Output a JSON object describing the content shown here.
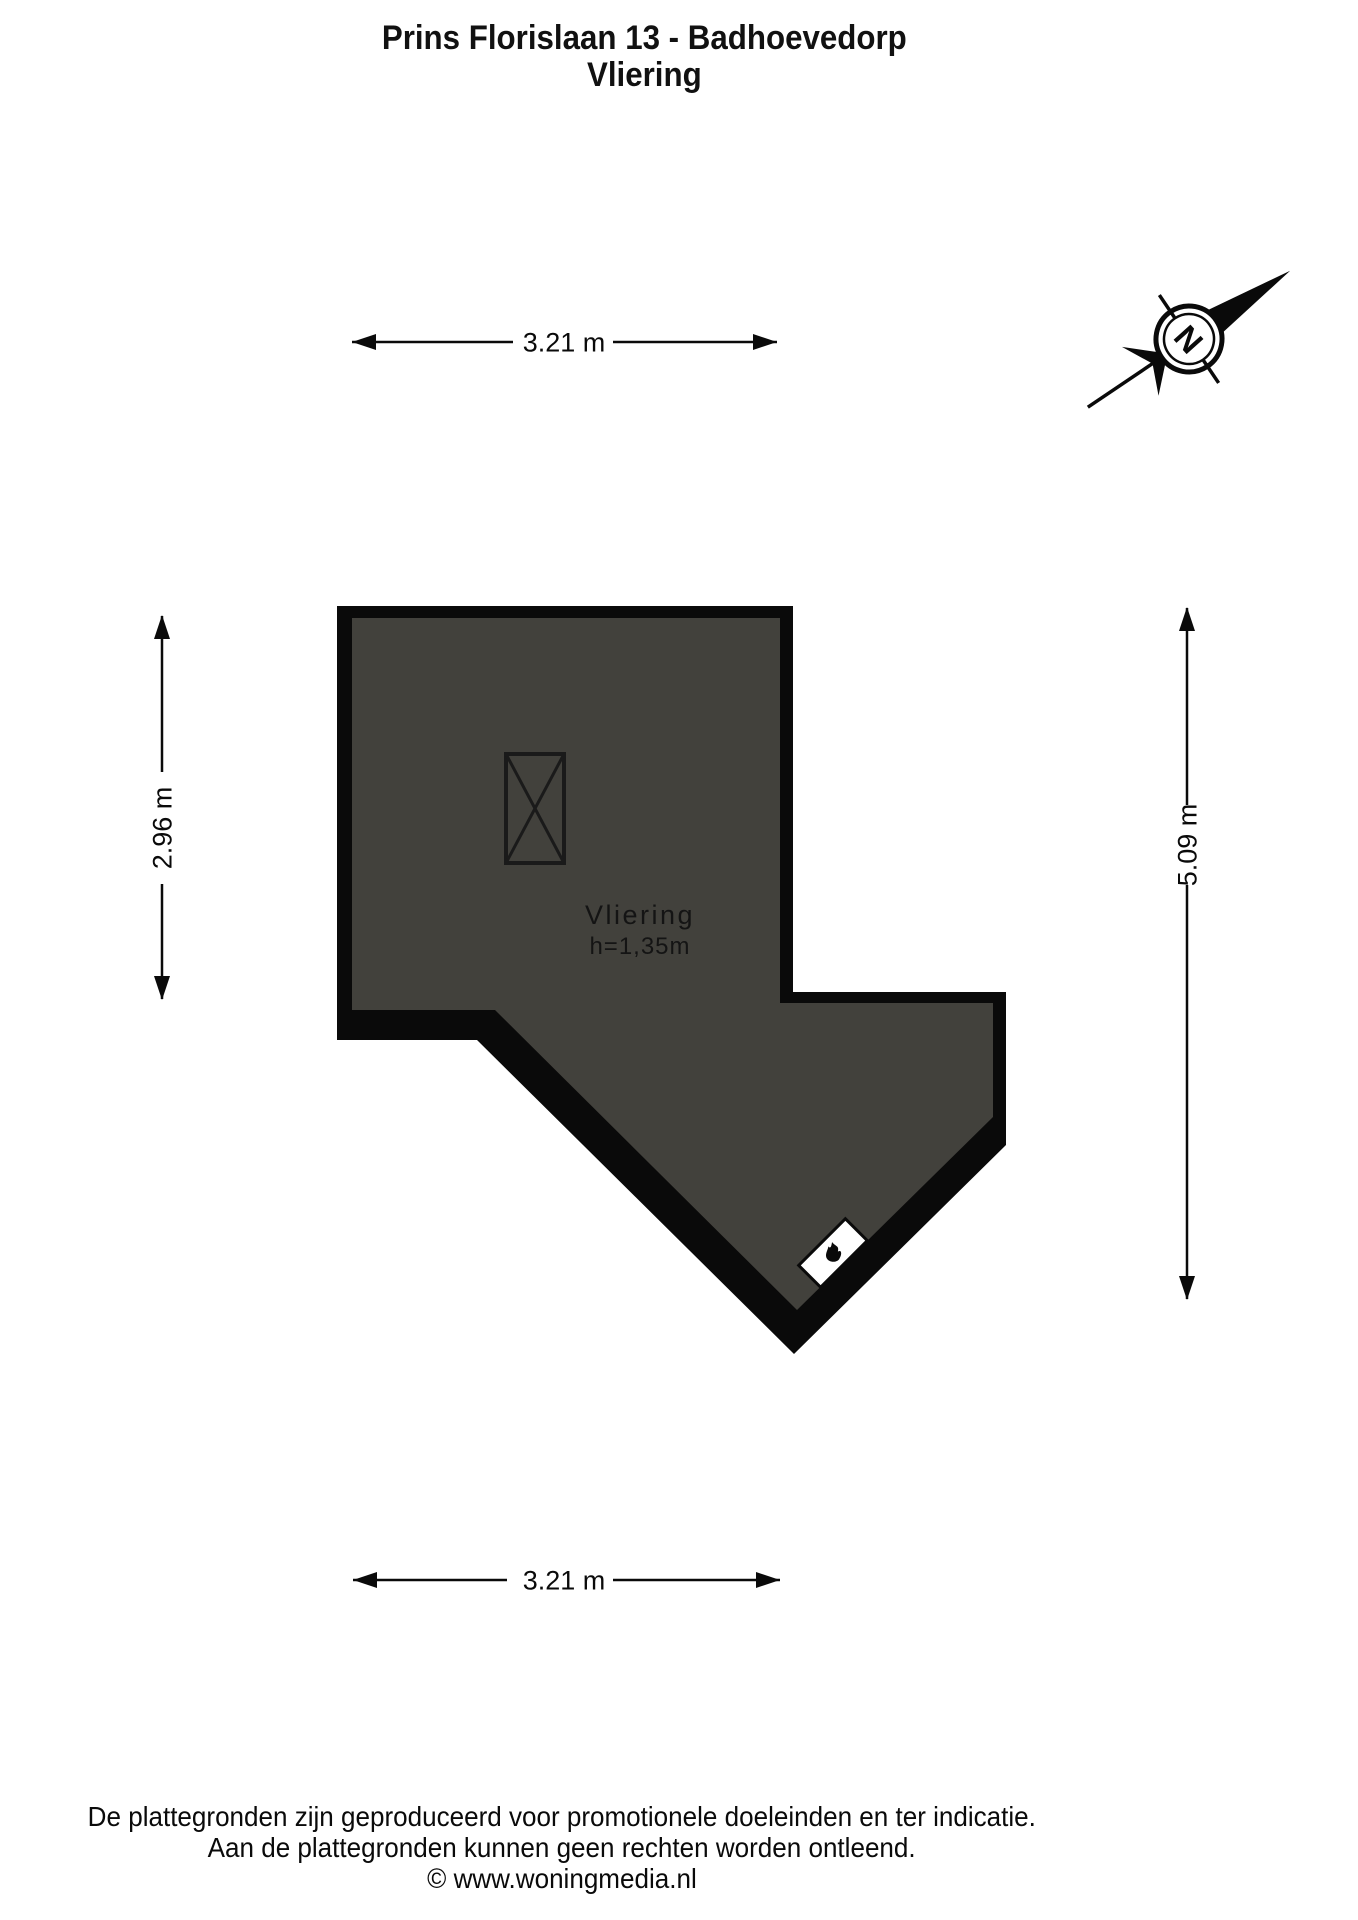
{
  "title": {
    "line1": "Prins Florislaan 13 - Badhoevedorp",
    "line2": "Vliering"
  },
  "room": {
    "name": "Vliering",
    "height_label": "h=1,35m"
  },
  "dimensions": {
    "top": "3.21 m",
    "left": "2.96 m",
    "right": "5.09 m",
    "bottom": "3.21 m"
  },
  "compass": {
    "north_label": "N"
  },
  "footer": {
    "line1": "De plattegronden zijn geproduceerd voor promotionele doeleinden en ter indicatie.",
    "line2": "Aan de plattegronden kunnen geen rechten worden ontleend.",
    "line3": "© www.woningmedia.nl"
  },
  "colors": {
    "background": "#ffffff",
    "wall": "#0a0a0a",
    "floor_fill": "#42413c",
    "text": "#000000"
  }
}
